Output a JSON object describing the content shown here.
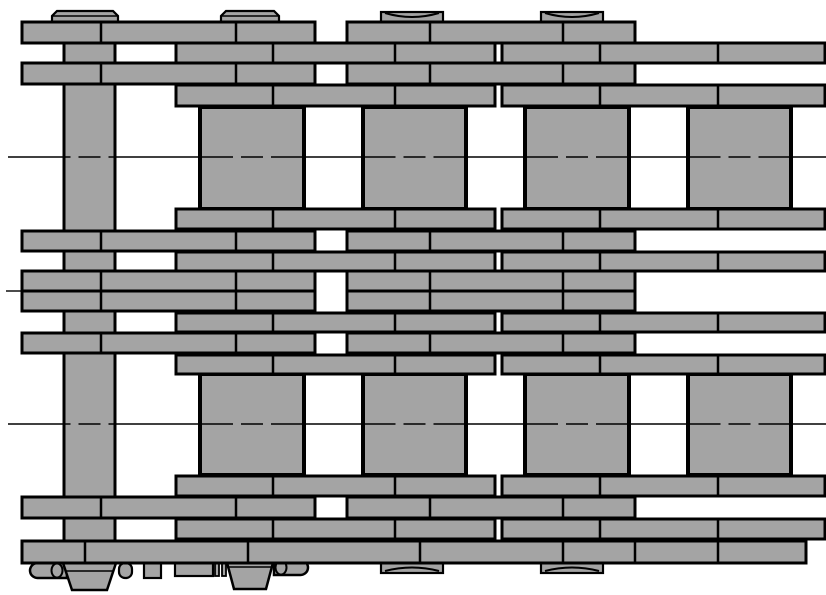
{
  "drawing": {
    "canvas": {
      "w": 826,
      "h": 595,
      "bg": "#ffffff"
    },
    "colors": {
      "fill": "#a4a4a4",
      "line": "#000000"
    },
    "pin_bar": {
      "x": 64,
      "y": 22,
      "w": 51,
      "h": 541
    },
    "rollers": {
      "bands": [
        {
          "y": 107,
          "h": 102
        },
        {
          "y": 374,
          "h": 101
        }
      ],
      "cols": [
        {
          "x": 200,
          "w": 104
        },
        {
          "x": 363,
          "w": 103
        },
        {
          "x": 525,
          "w": 104
        },
        {
          "x": 688,
          "w": 103
        }
      ]
    },
    "plate_rows": [
      {
        "id": "r1",
        "y": 22,
        "h": 21,
        "segs": [
          [
            22,
            293
          ],
          [
            347,
            288
          ]
        ],
        "divs": [
          101,
          236,
          430,
          563
        ]
      },
      {
        "id": "r2",
        "y": 43,
        "h": 20,
        "segs": [
          [
            176,
            319
          ],
          [
            502,
            323
          ]
        ],
        "divs": [
          273,
          395,
          600,
          718
        ]
      },
      {
        "id": "r3",
        "y": 63,
        "h": 21,
        "segs": [
          [
            22,
            293
          ],
          [
            347,
            288
          ]
        ],
        "divs": [
          101,
          236,
          430,
          563
        ]
      },
      {
        "id": "r4",
        "y": 85,
        "h": 21,
        "segs": [
          [
            176,
            319
          ],
          [
            502,
            323
          ]
        ],
        "divs": [
          273,
          395,
          600,
          718
        ]
      },
      {
        "id": "r5",
        "y": 209,
        "h": 20,
        "segs": [
          [
            176,
            319
          ],
          [
            502,
            323
          ]
        ],
        "divs": [
          273,
          395,
          600,
          718
        ]
      },
      {
        "id": "r6",
        "y": 231,
        "h": 20,
        "segs": [
          [
            22,
            293
          ],
          [
            347,
            288
          ]
        ],
        "divs": [
          101,
          236,
          430,
          563
        ]
      },
      {
        "id": "r7",
        "y": 252,
        "h": 19,
        "segs": [
          [
            176,
            319
          ],
          [
            502,
            323
          ]
        ],
        "divs": [
          273,
          395,
          600,
          718
        ]
      },
      {
        "id": "r8a",
        "y": 271,
        "h": 20,
        "segs": [
          [
            22,
            293
          ],
          [
            347,
            288
          ]
        ],
        "divs": [
          101,
          236,
          430,
          563
        ]
      },
      {
        "id": "r8b",
        "y": 291,
        "h": 20,
        "segs": [
          [
            22,
            293
          ],
          [
            347,
            288
          ]
        ],
        "divs": [
          101,
          236,
          430,
          563
        ]
      },
      {
        "id": "r9",
        "y": 313,
        "h": 19,
        "segs": [
          [
            176,
            319
          ],
          [
            502,
            323
          ]
        ],
        "divs": [
          273,
          395,
          600,
          718
        ]
      },
      {
        "id": "r10",
        "y": 333,
        "h": 20,
        "segs": [
          [
            22,
            293
          ],
          [
            347,
            288
          ]
        ],
        "divs": [
          101,
          236,
          430,
          563
        ]
      },
      {
        "id": "r11",
        "y": 355,
        "h": 19,
        "segs": [
          [
            176,
            319
          ],
          [
            502,
            323
          ]
        ],
        "divs": [
          273,
          395,
          600,
          718
        ]
      },
      {
        "id": "r12",
        "y": 476,
        "h": 20,
        "segs": [
          [
            176,
            319
          ],
          [
            502,
            323
          ]
        ],
        "divs": [
          273,
          395,
          600,
          718
        ]
      },
      {
        "id": "r13",
        "y": 497,
        "h": 21,
        "segs": [
          [
            22,
            293
          ],
          [
            347,
            288
          ]
        ],
        "divs": [
          101,
          236,
          430,
          563
        ]
      },
      {
        "id": "r14",
        "y": 519,
        "h": 20,
        "segs": [
          [
            176,
            319
          ],
          [
            502,
            323
          ]
        ],
        "divs": [
          273,
          395,
          600,
          718
        ]
      },
      {
        "id": "r15",
        "y": 541,
        "h": 22,
        "segs": [
          [
            22,
            784
          ]
        ],
        "divs": [
          85,
          248,
          420,
          563,
          635,
          718
        ]
      }
    ],
    "pin_heads_top": [
      {
        "type": "flat",
        "x": 52,
        "w": 66
      },
      {
        "type": "flat",
        "x": 221,
        "w": 58
      },
      {
        "type": "arc",
        "x": 381,
        "w": 62
      },
      {
        "type": "arc",
        "x": 541,
        "w": 62
      }
    ],
    "pin_heads_bottom": [
      {
        "type": "arc",
        "x": 381,
        "w": 62
      },
      {
        "type": "arc",
        "x": 541,
        "w": 62
      }
    ],
    "centerlines": [
      {
        "y": 157,
        "x1": 8,
        "x2": 826,
        "dashed": true
      },
      {
        "y": 291,
        "x1": 6,
        "x2": 22,
        "dashed": false
      },
      {
        "y": 424,
        "x1": 8,
        "x2": 826,
        "dashed": true
      }
    ],
    "centerline_dash": {
      "pattern": [
        124.5,
        8,
        22,
        8
      ],
      "offset": -100.5
    },
    "fasteners": [
      {
        "type": "pill",
        "x": 30,
        "y": 563,
        "w": 37,
        "h": 15,
        "cap": "left",
        "ecx": 57
      },
      {
        "type": "rect",
        "x": 67,
        "y": 562,
        "w": 6,
        "h": 16
      },
      {
        "type": "taper",
        "x": 63,
        "y": 563,
        "w": 53,
        "h": 27,
        "inset": 9,
        "hline": 571
      },
      {
        "type": "pillsm",
        "x": 119,
        "y": 563,
        "w": 13,
        "h": 15
      },
      {
        "type": "rect",
        "x": 144,
        "y": 563,
        "w": 17,
        "h": 15
      },
      {
        "type": "rect",
        "x": 175,
        "y": 561,
        "w": 38,
        "h": 15
      },
      {
        "type": "tick",
        "x": 215,
        "y": 561,
        "w": 4,
        "h": 15
      },
      {
        "type": "tick",
        "x": 222,
        "y": 561,
        "w": 4,
        "h": 15
      },
      {
        "type": "taper",
        "x": 226,
        "y": 559,
        "w": 48,
        "h": 30,
        "inset": 8,
        "hline": 567
      },
      {
        "type": "pill",
        "x": 274,
        "y": 560,
        "w": 34,
        "h": 15,
        "cap": "right",
        "ecx": 281
      }
    ]
  }
}
